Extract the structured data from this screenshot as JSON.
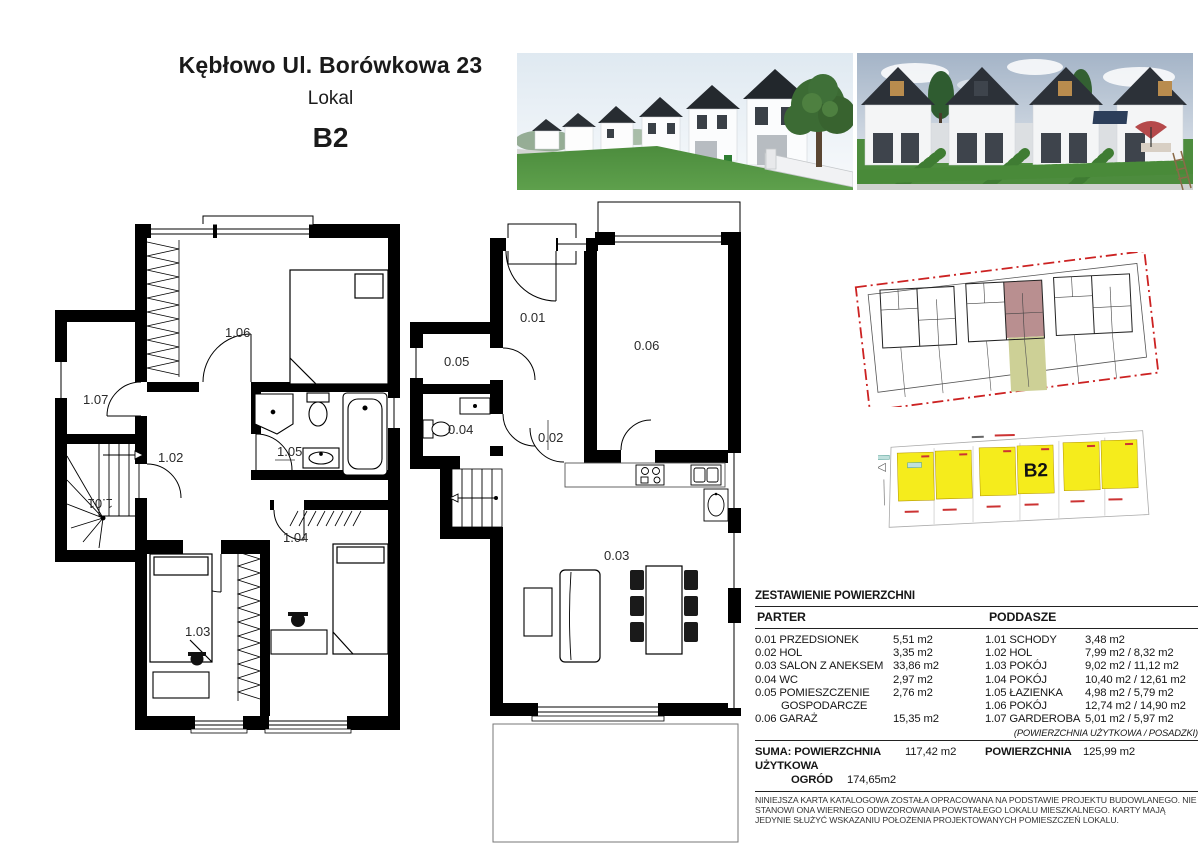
{
  "header": {
    "address": "Kębłowo Ul. Borówkowa 23",
    "lokal_label": "Lokal",
    "unit": "B2"
  },
  "plans": {
    "poddasze": {
      "rooms": [
        {
          "id": "1.01"
        },
        {
          "id": "1.02"
        },
        {
          "id": "1.03"
        },
        {
          "id": "1.04"
        },
        {
          "id": "1.05"
        },
        {
          "id": "1.06"
        },
        {
          "id": "1.07"
        }
      ]
    },
    "parter": {
      "rooms": [
        {
          "id": "0.01"
        },
        {
          "id": "0.02"
        },
        {
          "id": "0.03"
        },
        {
          "id": "0.04"
        },
        {
          "id": "0.05"
        },
        {
          "id": "0.06"
        }
      ]
    }
  },
  "plot_diagram": {
    "unit": "B2"
  },
  "colors": {
    "plot_yellow": "#f5ec1c",
    "unit_highlight": "#b98f90",
    "garden_olive": "#cdd096",
    "site_border_red": "#cc2222"
  },
  "area_table": {
    "title": "ZESTAWIENIE POWIERZCHNI",
    "parter": {
      "header": "PARTER",
      "rows": [
        {
          "label": "0.01 PRZEDSIONEK",
          "area": "5,51 m2"
        },
        {
          "label": "0.02 HOL",
          "area": "3,35 m2"
        },
        {
          "label": "0.03 SALON Z ANEKSEM",
          "area": "33,86 m2"
        },
        {
          "label": "0.04 WC",
          "area": "2,97 m2"
        },
        {
          "label": "0.05 POMIESZCZENIE",
          "area": "2,76 m2"
        },
        {
          "label": "GOSPODARCZE",
          "area": ""
        },
        {
          "label": "0.06 GARAŻ",
          "area": "15,35 m2"
        }
      ]
    },
    "poddasze": {
      "header": "PODDASZE",
      "rows": [
        {
          "label": "1.01 SCHODY",
          "area": "3,48 m2"
        },
        {
          "label": "1.02 HOL",
          "area": "7,99 m2 / 8,32 m2"
        },
        {
          "label": "1.03 POKÓJ",
          "area": "9,02 m2 / 11,12 m2"
        },
        {
          "label": "1.04 POKÓJ",
          "area": "10,40 m2 / 12,61 m2"
        },
        {
          "label": "1.05 ŁAZIENKA",
          "area": "4,98 m2 / 5,79 m2"
        },
        {
          "label": "1.06 POKÓJ",
          "area": "12,74 m2 / 14,90 m2"
        },
        {
          "label": "1.07 GARDEROBA",
          "area": "5,01 m2 / 5,97 m2"
        }
      ],
      "footnote": "(POWIERZCHNIA UŻYTKOWA / POSADZKI)"
    }
  },
  "summary": {
    "suma_label": "SUMA: POWIERZCHNIA UŻYTKOWA",
    "uzytkowa_value": "117,42 m2",
    "powierzchnia_label": "POWIERZCHNIA",
    "powierzchnia_value": "125,99 m2",
    "ogrod_label": "OGRÓD",
    "ogrod_value": "174,65m2"
  },
  "disclaimer": "NINIEJSZA KARTA KATALOGOWA ZOSTAŁA OPRACOWANA NA PODSTAWIE PROJEKTU BUDOWLANEGO. NIE STANOWI ONA WIERNEGO ODWZOROWANIA POWSTAŁEGO LOKALU MIESZKALNEGO. KARTY MAJĄ JEDYNIE SŁUŻYĆ WSKAZANIU POŁOŻENIA PROJEKTOWANYCH POMIESZCZEŃ LOKALU."
}
